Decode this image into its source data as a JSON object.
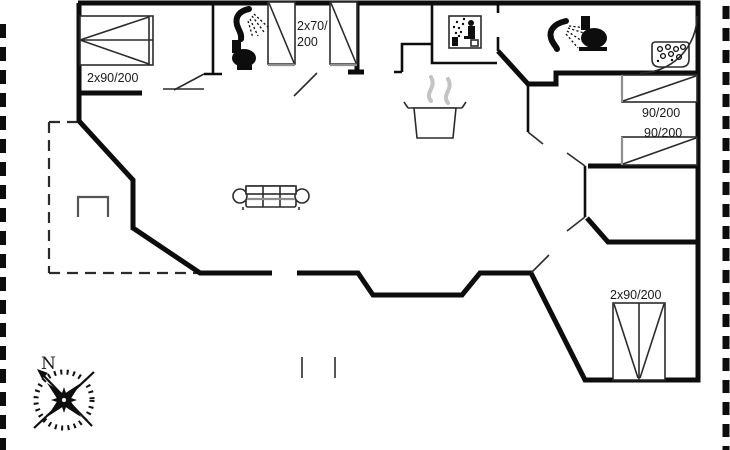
{
  "colors": {
    "background": "#ffffff",
    "wall": "#0d0d0d",
    "thin": "#2b2b2b",
    "gray": "#8f8f8f",
    "steam": "#c3c3c3",
    "ink": "#1a1a1a"
  },
  "labels": {
    "bed_top_left": "2x90/200",
    "bed_top_middle_line1": "2x70/",
    "bed_top_middle_line2": "200",
    "bed_right_upper": "90/200",
    "bed_right_lower": "90/200",
    "bed_bottom_right": "2x90/200",
    "compass_north": "N"
  },
  "icons": [
    "shower-icon",
    "toilet-icon",
    "sauna-icon",
    "shower-icon",
    "toilet-icon",
    "whirlpool-icon",
    "cooking-pot-icon",
    "sofa",
    "fireplace",
    "compass-rose",
    "double-bed",
    "single-bed",
    "door-swing"
  ]
}
